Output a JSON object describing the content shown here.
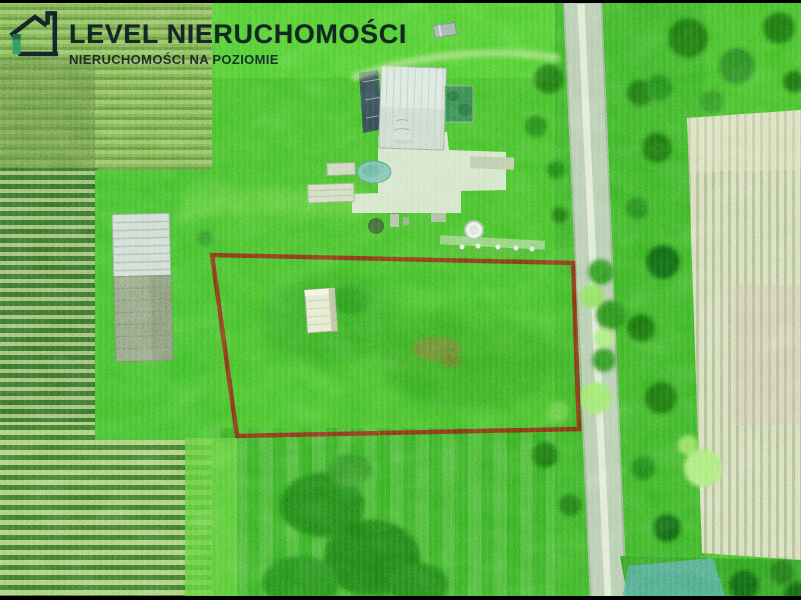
{
  "watermark": {
    "brand": "LEVEL NIERUCHOMOŚCI",
    "tagline": "NIERUCHOMOŚCI NA POZIOMIE",
    "icon": "house-with-level-logo",
    "text_color": "#0a1420",
    "accent_color": "#2f9e68"
  },
  "photo": {
    "kind": "aerial-drone-view-of-building-plot",
    "plot_boundary": {
      "points": "212,255 573,263 579,429 237,436",
      "color": "#73301c"
    },
    "letterbox": {
      "color": "#000000"
    },
    "palette": {
      "grass": "#4fae3a",
      "trees_dark": "#27691f",
      "trees_bright": "#8ed068",
      "road": "#aec0a8",
      "plowed_field_dark": "#3b6630",
      "plowed_field_light": "#96b376",
      "right_field_stripes": "#c7ccae",
      "roof_light": "#d2dcd5",
      "roof_dark": "#35464c",
      "greenhouse": "#3c7a4e",
      "pond": "#79b3a3",
      "courtyard": "#cbd9c1",
      "shed": "#dadec9"
    }
  }
}
